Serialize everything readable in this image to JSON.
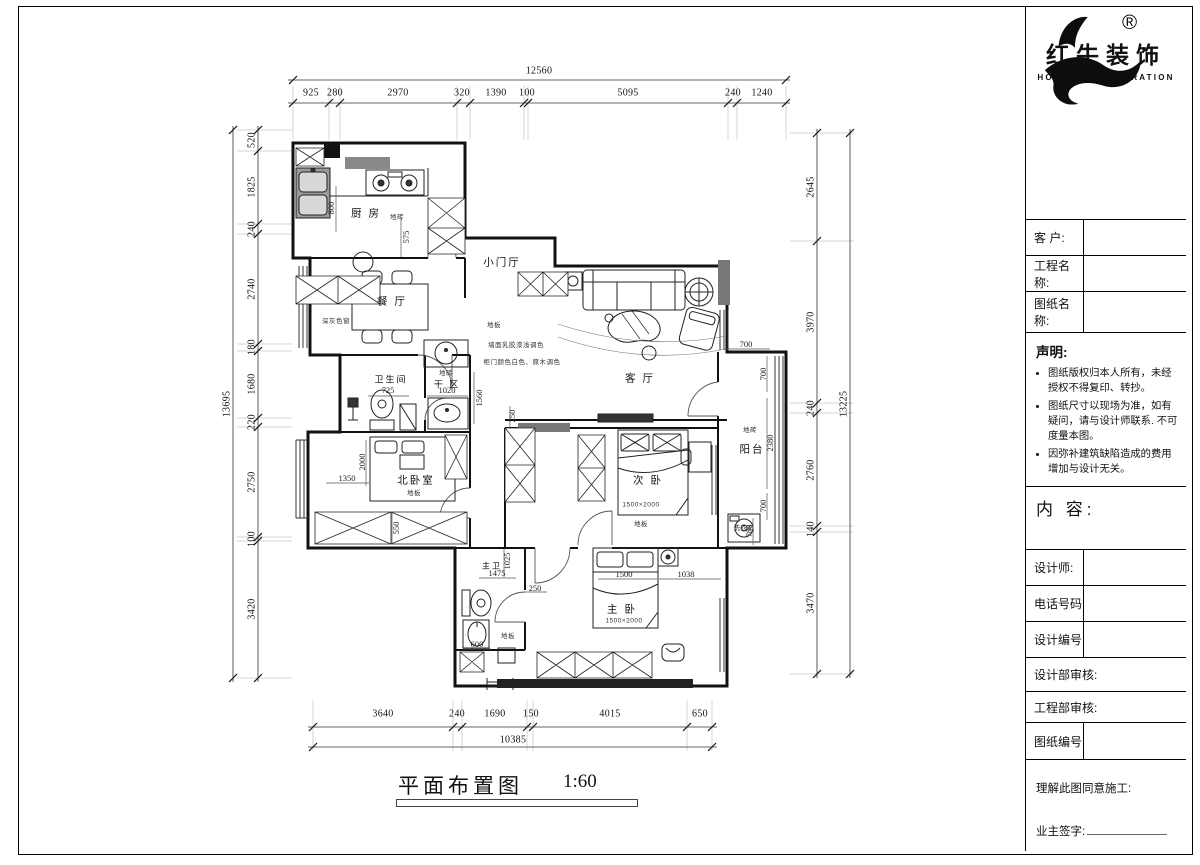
{
  "sheet": {
    "plan_title": "平面布置图",
    "plan_scale": "1:60"
  },
  "logo": {
    "brand_cn": "红牛装饰",
    "brand_en": "HONG NIU DECORATION",
    "reg": "®"
  },
  "panel": {
    "client_label": "客  户:",
    "project_label": "工程名称:",
    "drawing_label": "图纸名称:",
    "statement_title": "声明:",
    "statement_items": [
      "图纸版权归本人所有，未经授权不得复印、转抄。",
      "图纸尺寸以现场为准，如有疑问，请与设计师联系. 不可度量本图。",
      "因弥补建筑缺陷造成的费用增加与设计无关。"
    ],
    "content_label": "内 容:",
    "designer_label": "设计师:",
    "phone_label": "电话号码",
    "design_no_label": "设计编号",
    "design_review_label": "设计部审核:",
    "eng_review_label": "工程部审核:",
    "drawing_no_label": "图纸编号",
    "agree_label": "理解此图同意施工:",
    "owner_sign_label": "业主签字:"
  },
  "dims": {
    "top_total": "12560",
    "top": [
      "925",
      "280",
      "2970",
      "320",
      "1390",
      "100",
      "5095",
      "240",
      "1240"
    ],
    "left_total": "13695",
    "left": [
      "520",
      "1825",
      "240",
      "2740",
      "180",
      "1680",
      "220",
      "2750",
      "100",
      "3420"
    ],
    "right_total": "13225",
    "right": [
      "2645",
      "3970",
      "240",
      "2760",
      "140",
      "3470"
    ],
    "bottom_total": "10385",
    "bottom": [
      "3640",
      "240",
      "1690",
      "150",
      "4015",
      "650"
    ]
  },
  "rooms": {
    "kitchen": "厨 房",
    "dining": "餐 厅",
    "foyer": "小门厅",
    "living": "客 厅",
    "bathroom": "卫生间",
    "dry_area": "干 区",
    "north_bedroom": "北卧室",
    "second_bedroom": "次 卧",
    "balcony": "阳台",
    "master_bedroom": "主 卧",
    "master_bathroom": "主卫"
  },
  "plan_dims": [
    "800",
    "575",
    "725",
    "1020",
    "1560",
    "1350",
    "2000",
    "550",
    "700",
    "700",
    "2380",
    "700",
    "780",
    "1500",
    "1038",
    "1475",
    "1025",
    "600",
    "250",
    "250"
  ],
  "plan_notes": [
    "地砖",
    "地板",
    "墙面乳胶漆浅调色",
    "柜门颜色白色、原木调色",
    "地砖",
    "地板",
    "地板",
    "地板",
    "地砖",
    "洗衣机",
    "1500×2000",
    "1500×2000",
    "深灰色窗"
  ]
}
